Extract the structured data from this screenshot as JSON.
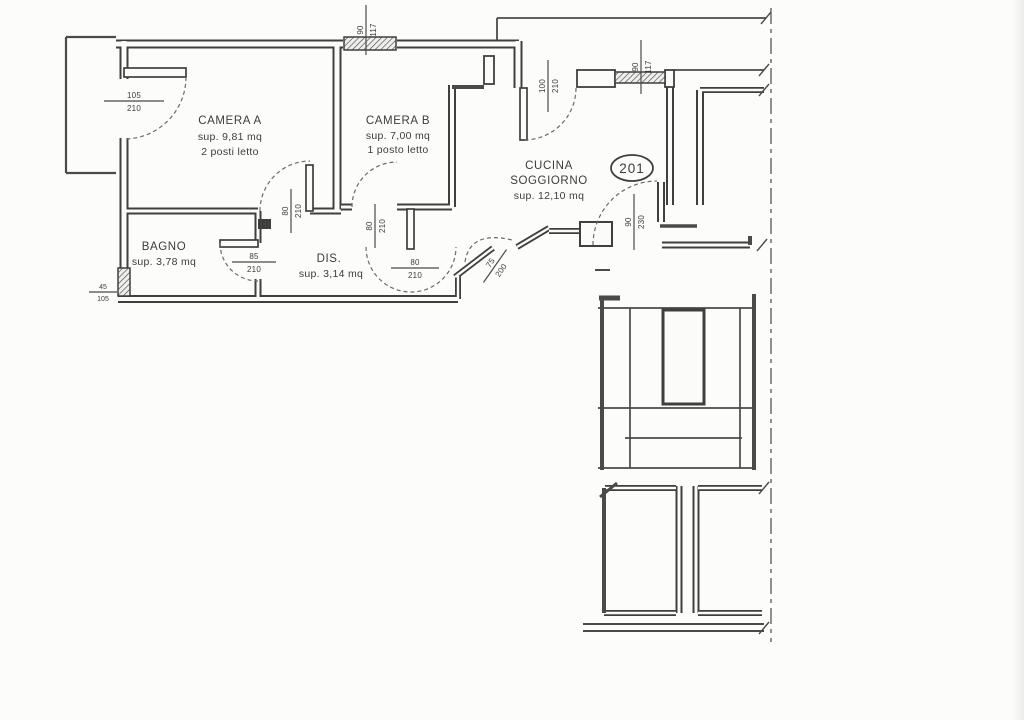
{
  "plan": {
    "unit_number": "201",
    "rooms": [
      {
        "id": "camera-a",
        "name": "CAMERA A",
        "area": "sup. 9,81 mq",
        "note": "2 posti letto"
      },
      {
        "id": "camera-b",
        "name": "CAMERA B",
        "area": "sup. 7,00 mq",
        "note": "1 posto letto"
      },
      {
        "id": "cucina-soggiorno",
        "name": "CUCINA",
        "name2": "SOGGIORNO",
        "area": "sup. 12,10 mq"
      },
      {
        "id": "bagno",
        "name": "BAGNO",
        "area": "sup. 3,78 mq"
      },
      {
        "id": "dis",
        "name": "DIS.",
        "area": "sup. 3,14 mq"
      }
    ],
    "dimensions": [
      {
        "id": "balcony-door",
        "width": "105",
        "height": "210"
      },
      {
        "id": "camera-b-window",
        "width": "90",
        "height": "117"
      },
      {
        "id": "hall-opening",
        "width": "100",
        "height": "210"
      },
      {
        "id": "cucina-window",
        "width": "90",
        "height": "117"
      },
      {
        "id": "camera-a-door",
        "width": "80",
        "height": "210"
      },
      {
        "id": "camera-b-door",
        "width": "80",
        "height": "210"
      },
      {
        "id": "bagno-door",
        "width": "85",
        "height": "210"
      },
      {
        "id": "dis-cucina-door",
        "width": "80",
        "height": "210"
      },
      {
        "id": "diagonal-door",
        "width": "75",
        "height": "200"
      },
      {
        "id": "entrance-door",
        "width": "90",
        "height": "230"
      },
      {
        "id": "bagno-window",
        "width": "45",
        "height": "105"
      }
    ],
    "colors": {
      "paper": "#fbfbf9",
      "ink": "#3f3f3f",
      "thin": "#4a4a4a"
    }
  }
}
